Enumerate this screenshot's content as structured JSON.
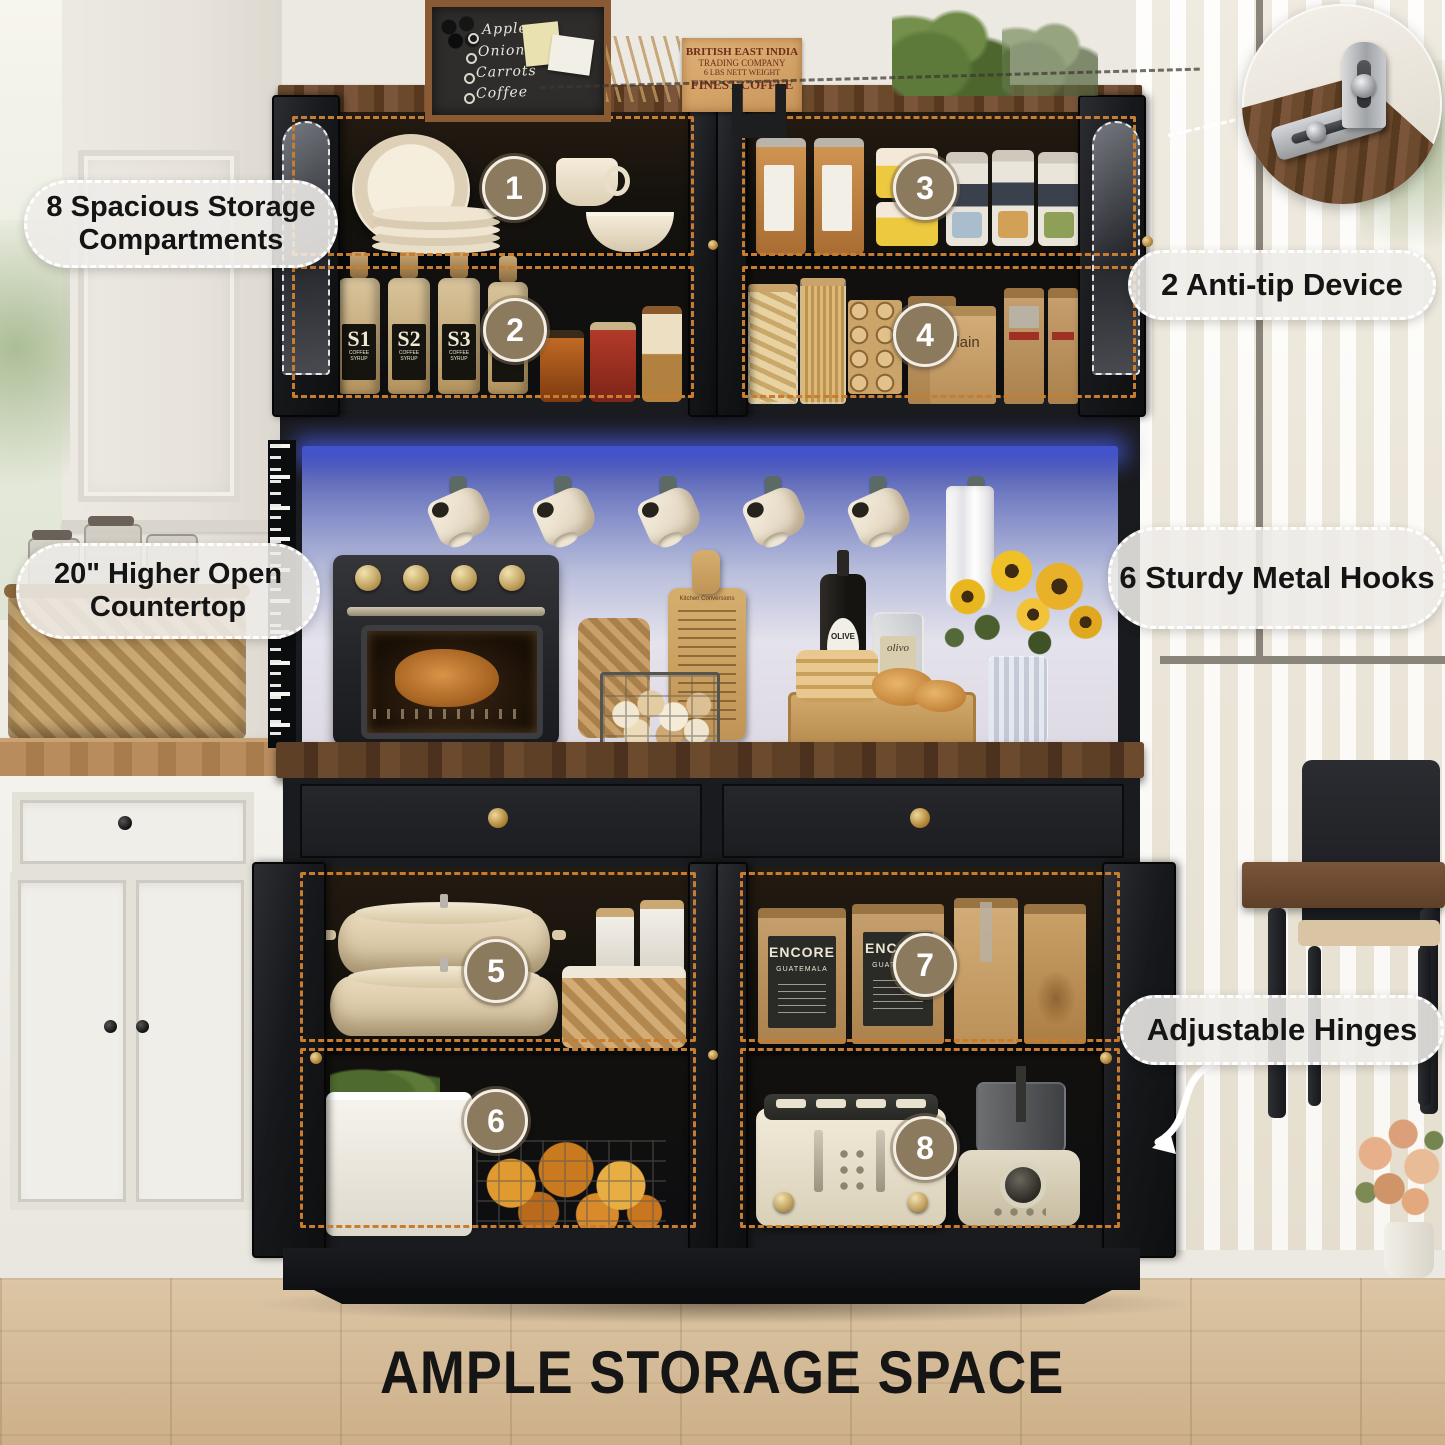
{
  "title": "AMPLE STORAGE SPACE",
  "callouts": {
    "compartments": "8 Spacious Storage Compartments",
    "anti_tip": "2 Anti-tip Device",
    "countertop": "20\" Higher Open Countertop",
    "hooks": "6 Sturdy Metal Hooks",
    "hinges": "Adjustable Hinges"
  },
  "badges": [
    "1",
    "2",
    "3",
    "4",
    "5",
    "6",
    "7",
    "8"
  ],
  "decor": {
    "chalkboard_lines": [
      "Apples",
      "Onions",
      "Carrots",
      "Coffee"
    ],
    "coffee_sign_lines": [
      "BRITISH EAST INDIA",
      "TRADING COMPANY",
      "6 LBS NETT WEIGHT",
      "FINEST COFFEE"
    ],
    "syrup_bottles": [
      "S1",
      "S2",
      "S3",
      "C1"
    ],
    "syrup_subtitle": "COFFEE SYRUP",
    "cocoa_subtitle": "COCOA",
    "coffee_bag": {
      "brand": "ENCORE",
      "origin": "GUATEMALA"
    },
    "plain_bag_label": "Plain",
    "olive_bottle_label": "OLIVE",
    "olivo_bottle_label": "olivo",
    "board_title": "Kitchen Conversions"
  },
  "colors": {
    "dashed_outline": "#c87c2e",
    "badge_fill": "#8b7a5e",
    "led_blue": "#4353cc",
    "cabinet_black": "#1a1b1e",
    "countertop_wood": "#5a3d28",
    "label_text": "#141414"
  }
}
